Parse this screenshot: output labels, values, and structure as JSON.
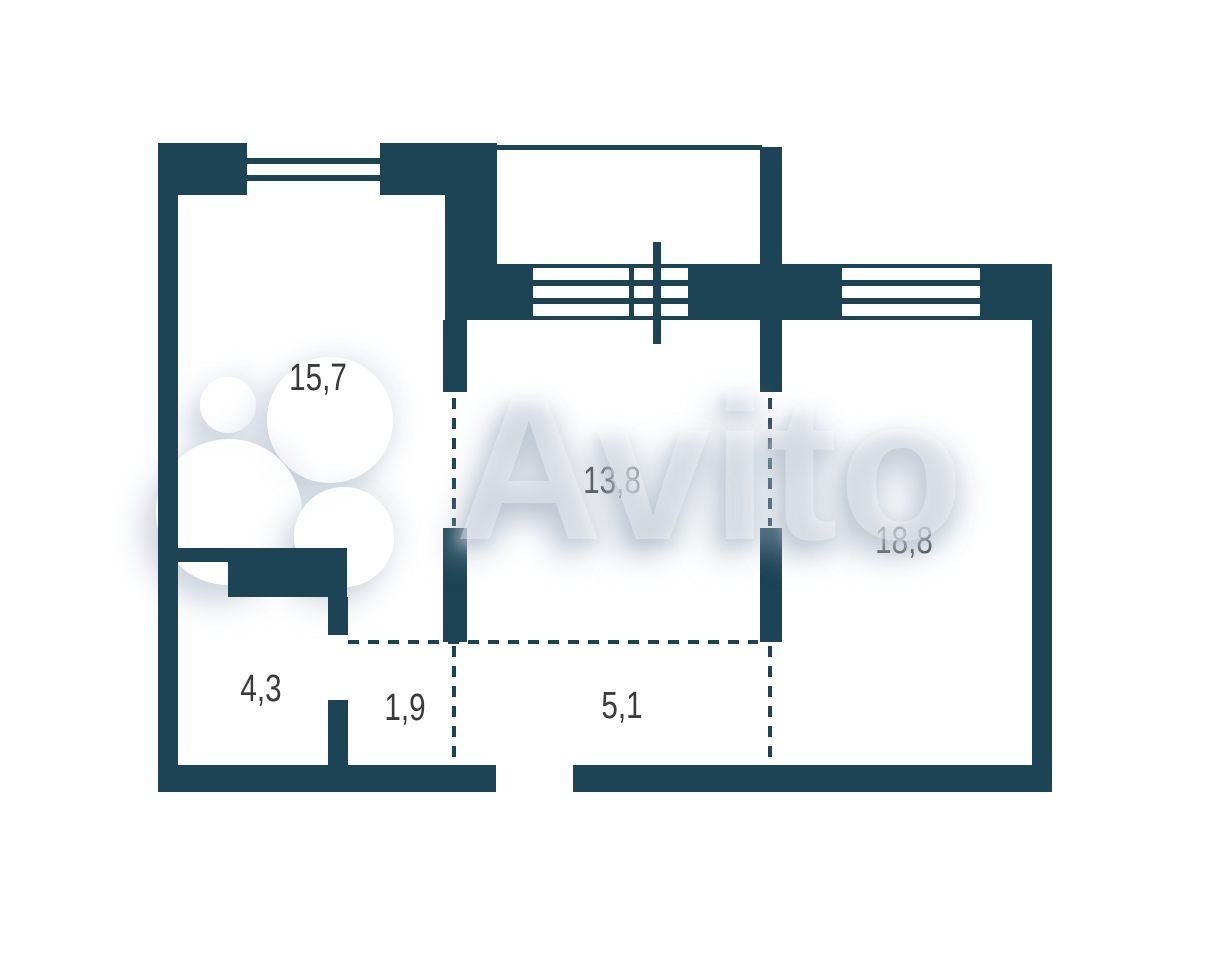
{
  "colors": {
    "wall": "#1c4454",
    "label": "#3a3a3a",
    "background": "#ffffff",
    "watermark": "#aab6c6"
  },
  "watermark": {
    "text": "Avito"
  },
  "floorplan": {
    "room_labels": [
      {
        "id": "room-15-7",
        "area": "15,7"
      },
      {
        "id": "room-13-8",
        "area": "13,8"
      },
      {
        "id": "room-18-8",
        "area": "18,8"
      },
      {
        "id": "room-4-3",
        "area": "4,3"
      },
      {
        "id": "room-1-9",
        "area": "1,9"
      },
      {
        "id": "room-5-1",
        "area": "5,1"
      }
    ]
  }
}
